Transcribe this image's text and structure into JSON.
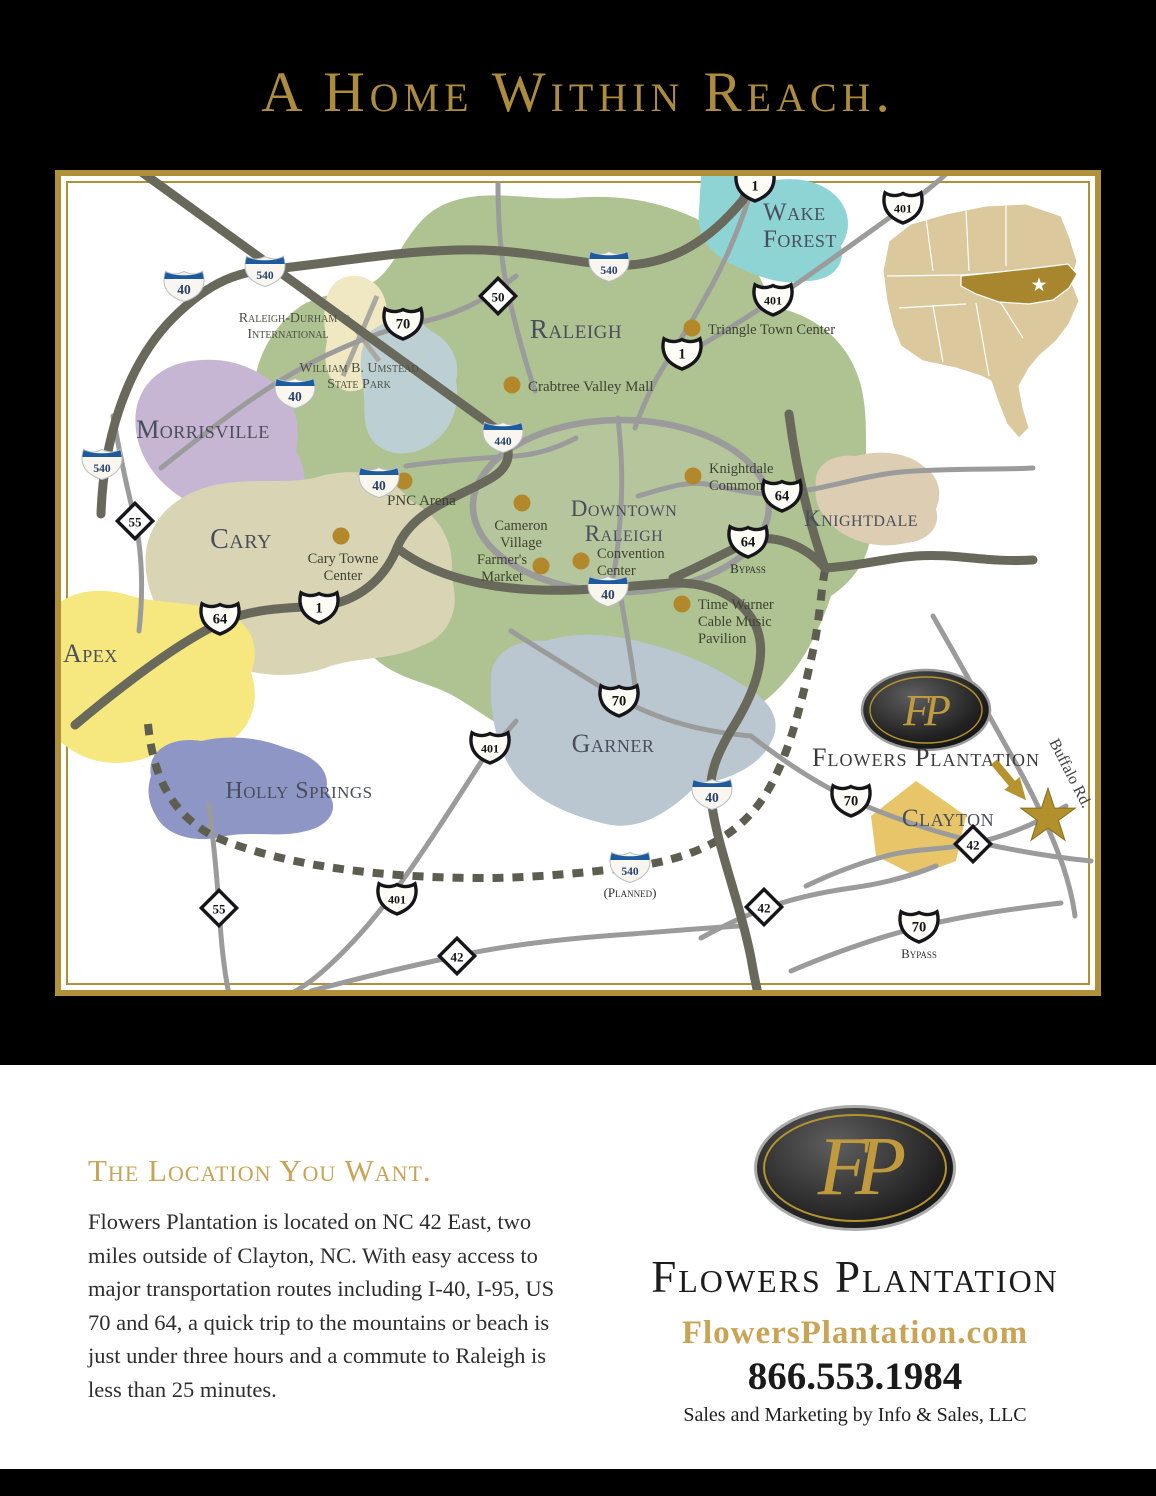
{
  "title": "A Home Within Reach.",
  "colors": {
    "gold": "#ad8c3e",
    "heading_gold": "#c9a455",
    "frame_gold": "#b09038",
    "raleigh_green": "#aec292",
    "morrisville_purple": "#c6b6d3",
    "cary_olive": "#d9d5b4",
    "apex_yellow": "#f6e87e",
    "holly_springs_blue": "#8e96c6",
    "garner_gray": "#bac7d0",
    "wake_forest_teal": "#8fd4d5",
    "knightdale_tan": "#dccdb3",
    "clayton_gold": "#e8c568",
    "poi_dot": "#b2882b",
    "major_road": "#69695b",
    "minor_road": "#9b9b9b",
    "interstate_blue": "#1d5b9e",
    "nc_inset_gold": "#a8862d"
  },
  "map": {
    "cities": [
      {
        "lines": [
          "Raleigh"
        ],
        "x": 515,
        "y": 162,
        "size": 27,
        "anchor": "middle",
        "lh": 28
      },
      {
        "lines": [
          "Wake",
          "Forest"
        ],
        "x": 702,
        "y": 44,
        "size": 25,
        "anchor": "start",
        "lh": 27
      },
      {
        "lines": [
          "Morrisville"
        ],
        "x": 142,
        "y": 262,
        "size": 26,
        "anchor": "middle",
        "lh": 28
      },
      {
        "lines": [
          "Cary"
        ],
        "x": 180,
        "y": 372,
        "size": 28,
        "anchor": "middle",
        "lh": 28
      },
      {
        "lines": [
          "Apex"
        ],
        "x": 2,
        "y": 486,
        "size": 26,
        "anchor": "start",
        "lh": 28
      },
      {
        "lines": [
          "Holly Springs"
        ],
        "x": 238,
        "y": 622,
        "size": 24,
        "anchor": "middle",
        "lh": 26
      },
      {
        "lines": [
          "Garner"
        ],
        "x": 552,
        "y": 576,
        "size": 26,
        "anchor": "middle",
        "lh": 28
      },
      {
        "lines": [
          "Downtown",
          "Raleigh"
        ],
        "x": 563,
        "y": 340,
        "size": 23,
        "anchor": "middle",
        "lh": 25
      },
      {
        "lines": [
          "Knightdale"
        ],
        "x": 800,
        "y": 350,
        "size": 23,
        "anchor": "middle",
        "lh": 25
      },
      {
        "lines": [
          "Clayton"
        ],
        "x": 887,
        "y": 650,
        "size": 25,
        "anchor": "middle",
        "lh": 27
      }
    ],
    "areas": [
      {
        "lines": [
          "Raleigh-Durham",
          "International"
        ],
        "x": 227,
        "y": 146,
        "size": 14,
        "lh": 16
      },
      {
        "lines": [
          "William B. Umstead",
          "State Park"
        ],
        "x": 298,
        "y": 196,
        "size": 14,
        "lh": 16
      }
    ],
    "pois": [
      {
        "label_lines": [
          "Triangle Town Center"
        ],
        "dot": [
          631,
          152
        ],
        "tx": 647,
        "ty": 158,
        "anchor": "start",
        "size": 14.5,
        "lh": 17
      },
      {
        "label_lines": [
          "Crabtree Valley Mall"
        ],
        "dot": [
          451,
          209
        ],
        "tx": 467,
        "ty": 215,
        "anchor": "start",
        "size": 15,
        "lh": 17
      },
      {
        "label_lines": [
          "PNC Arena"
        ],
        "dot": [
          343,
          305
        ],
        "tx": 326,
        "ty": 329,
        "anchor": "start",
        "size": 15,
        "lh": 17
      },
      {
        "label_lines": [
          "Cary Towne",
          "Center"
        ],
        "dot": [
          280,
          360
        ],
        "tx": 282,
        "ty": 387,
        "anchor": "middle",
        "size": 14.5,
        "lh": 17
      },
      {
        "label_lines": [
          "Cameron",
          "Village"
        ],
        "dot": [
          461,
          327
        ],
        "tx": 460,
        "ty": 354,
        "anchor": "middle",
        "size": 14.5,
        "lh": 17
      },
      {
        "label_lines": [
          "Farmer's",
          "Market"
        ],
        "dot": [
          480,
          390
        ],
        "tx": 441,
        "ty": 388,
        "anchor": "middle",
        "size": 14.5,
        "lh": 17
      },
      {
        "label_lines": [
          "Convention",
          "Center"
        ],
        "dot": [
          520,
          385
        ],
        "tx": 536,
        "ty": 382,
        "anchor": "start",
        "size": 14.5,
        "lh": 17
      },
      {
        "label_lines": [
          "Knightdale",
          "Commons"
        ],
        "dot": [
          632,
          300
        ],
        "tx": 648,
        "ty": 297,
        "anchor": "start",
        "size": 14.5,
        "lh": 17
      },
      {
        "label_lines": [
          "Time Warner",
          "Cable Music",
          "Pavilion"
        ],
        "dot": [
          621,
          428
        ],
        "tx": 637,
        "ty": 433,
        "anchor": "start",
        "size": 14.5,
        "lh": 17
      }
    ],
    "shields": [
      {
        "type": "i",
        "label": "40",
        "x": 123,
        "y": 109
      },
      {
        "type": "i",
        "label": "540",
        "x": 204,
        "y": 94
      },
      {
        "type": "i",
        "label": "540",
        "x": 548,
        "y": 89
      },
      {
        "type": "i",
        "label": "40",
        "x": 234,
        "y": 216
      },
      {
        "type": "i",
        "label": "440",
        "x": 442,
        "y": 260
      },
      {
        "type": "i",
        "label": "540",
        "x": 41,
        "y": 287
      },
      {
        "type": "i",
        "label": "40",
        "x": 318,
        "y": 305
      },
      {
        "type": "i",
        "label": "40",
        "x": 547,
        "y": 414
      },
      {
        "type": "i",
        "label": "40",
        "x": 651,
        "y": 617
      },
      {
        "type": "i",
        "label": "540",
        "x": 569,
        "y": 690,
        "sub": "(Planned)"
      },
      {
        "type": "us",
        "label": "70",
        "x": 342,
        "y": 146
      },
      {
        "type": "us",
        "label": "1",
        "x": 694,
        "y": 8
      },
      {
        "type": "us",
        "label": "401",
        "x": 842,
        "y": 30
      },
      {
        "type": "us",
        "label": "401",
        "x": 712,
        "y": 122
      },
      {
        "type": "us",
        "label": "1",
        "x": 621,
        "y": 176
      },
      {
        "type": "us",
        "label": "64",
        "x": 159,
        "y": 441
      },
      {
        "type": "us",
        "label": "1",
        "x": 258,
        "y": 430
      },
      {
        "type": "us",
        "label": "64",
        "x": 721,
        "y": 318
      },
      {
        "type": "us",
        "label": "64",
        "x": 687,
        "y": 364,
        "sub": "Bypass"
      },
      {
        "type": "us",
        "label": "70",
        "x": 558,
        "y": 523
      },
      {
        "type": "us",
        "label": "401",
        "x": 429,
        "y": 570
      },
      {
        "type": "us",
        "label": "401",
        "x": 336,
        "y": 721
      },
      {
        "type": "us",
        "label": "70",
        "x": 790,
        "y": 623
      },
      {
        "type": "us",
        "label": "70",
        "x": 858,
        "y": 749,
        "sub": "Bypass"
      },
      {
        "type": "nc",
        "label": "50",
        "x": 437,
        "y": 120
      },
      {
        "type": "nc",
        "label": "55",
        "x": 74,
        "y": 345
      },
      {
        "type": "nc",
        "label": "55",
        "x": 158,
        "y": 732
      },
      {
        "type": "nc",
        "label": "42",
        "x": 703,
        "y": 731
      },
      {
        "type": "nc",
        "label": "42",
        "x": 912,
        "y": 668
      },
      {
        "type": "nc",
        "label": "42",
        "x": 396,
        "y": 780
      }
    ],
    "road_labels": [
      {
        "text": "Buffalo Rd.",
        "x": 988,
        "y": 566,
        "rotate": 63,
        "size": 16
      }
    ],
    "fp_marker": {
      "monogram": "FP",
      "label": "Flowers Plantation"
    }
  },
  "bottom": {
    "heading": "The Location You Want.",
    "paragraph": "Flowers Plantation is located on NC 42 East, two miles outside of Clayton, NC. With easy access to major transportation routes including I-40, I-95, US 70 and 64, a quick trip to the mountains or beach is just under three hours and a commute to Raleigh is less than 25 minutes.",
    "logo_monogram": "FP",
    "brand": "Flowers Plantation",
    "website": "FlowersPlantation.com",
    "phone": "866.553.1984",
    "sales_line": "Sales and Marketing by Info & Sales, LLC"
  }
}
